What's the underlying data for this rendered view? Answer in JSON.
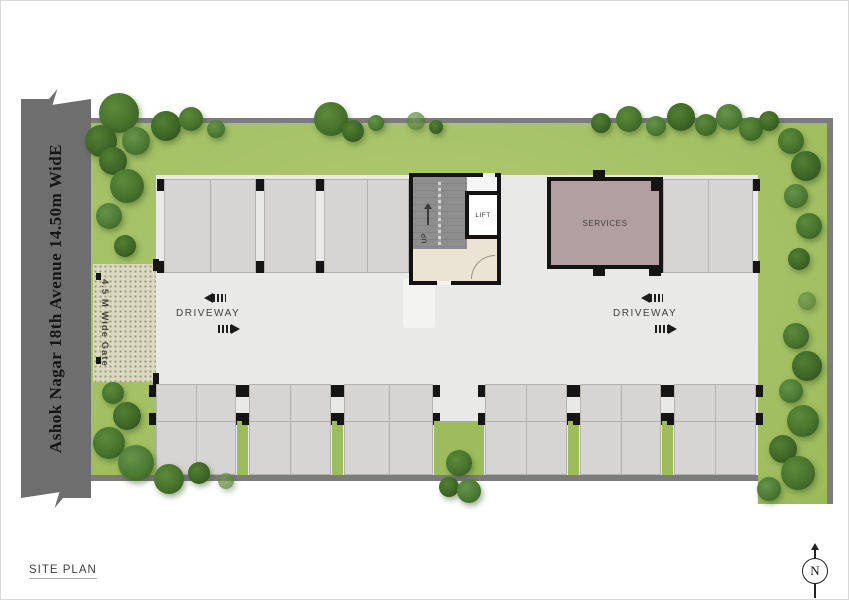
{
  "page": {
    "title": "SITE PLAN"
  },
  "road": {
    "label": "Ashok Nagar 18th Avenue 14.50m WidE"
  },
  "gate": {
    "label": "4.5 M Wide Gate"
  },
  "driveways": {
    "left": "DRIVEWAY",
    "right": "DRIVEWAY"
  },
  "core": {
    "up": "UP",
    "lift": "LIFT"
  },
  "services": {
    "label": "SERVICES"
  },
  "compass": {
    "north": "N"
  },
  "colors": {
    "road": "#6e6e6e",
    "lawn": "#a6c267",
    "wall": "#7c7c7c",
    "paving": "#e9e9e7",
    "stall": "#d7d5d3",
    "column": "#151515",
    "services": "#b2a0a0",
    "stair": "#8b8b8b",
    "lobby": "#ebe4d4",
    "gate": "#dbd9c0",
    "tree": "#3e6626"
  },
  "trees": [
    [
      118,
      112,
      20,
      0
    ],
    [
      100,
      140,
      16,
      1
    ],
    [
      135,
      140,
      14,
      2
    ],
    [
      165,
      125,
      15,
      1
    ],
    [
      190,
      118,
      12,
      0
    ],
    [
      215,
      128,
      9,
      2
    ],
    [
      330,
      118,
      17,
      0
    ],
    [
      352,
      130,
      11,
      1
    ],
    [
      375,
      122,
      8,
      2
    ],
    [
      415,
      120,
      9,
      3
    ],
    [
      435,
      126,
      7,
      1
    ],
    [
      600,
      122,
      10,
      1
    ],
    [
      628,
      118,
      13,
      0
    ],
    [
      655,
      125,
      10,
      2
    ],
    [
      680,
      116,
      14,
      1
    ],
    [
      705,
      124,
      11,
      0
    ],
    [
      728,
      116,
      13,
      2
    ],
    [
      750,
      128,
      12,
      0
    ],
    [
      768,
      120,
      10,
      1
    ],
    [
      790,
      140,
      13,
      0
    ],
    [
      805,
      165,
      15,
      1
    ],
    [
      795,
      195,
      12,
      2
    ],
    [
      808,
      225,
      13,
      0
    ],
    [
      798,
      258,
      11,
      1
    ],
    [
      806,
      300,
      9,
      3
    ],
    [
      795,
      335,
      13,
      0
    ],
    [
      806,
      365,
      15,
      1
    ],
    [
      790,
      390,
      12,
      2
    ],
    [
      802,
      420,
      16,
      0
    ],
    [
      782,
      448,
      14,
      1
    ],
    [
      797,
      472,
      17,
      0
    ],
    [
      768,
      488,
      12,
      2
    ],
    [
      112,
      160,
      14,
      1
    ],
    [
      126,
      185,
      17,
      0
    ],
    [
      108,
      215,
      13,
      2
    ],
    [
      124,
      245,
      11,
      1
    ],
    [
      112,
      392,
      11,
      0
    ],
    [
      126,
      415,
      14,
      1
    ],
    [
      108,
      442,
      16,
      0
    ],
    [
      135,
      462,
      18,
      2
    ],
    [
      168,
      478,
      15,
      0
    ],
    [
      198,
      472,
      11,
      1
    ],
    [
      225,
      480,
      8,
      3
    ],
    [
      458,
      462,
      13,
      0
    ],
    [
      448,
      486,
      10,
      1
    ],
    [
      468,
      490,
      12,
      2
    ]
  ],
  "parking": {
    "top_groups": [
      {
        "x": 163,
        "w": 92,
        "stalls": 2
      },
      {
        "x": 263,
        "w": 52,
        "stalls": 1
      },
      {
        "x": 323,
        "w": 85,
        "stalls": 2
      },
      {
        "x": 662,
        "w": 90,
        "stalls": 2
      }
    ],
    "top_y": 178,
    "top_h": 94,
    "bottom_groups": [
      {
        "x": 155,
        "w": 80,
        "stalls": 2
      },
      {
        "x": 248,
        "w": 82,
        "stalls": 2
      },
      {
        "x": 343,
        "w": 89,
        "stalls": 2
      },
      {
        "x": 484,
        "w": 82,
        "stalls": 2
      },
      {
        "x": 579,
        "w": 81,
        "stalls": 2
      },
      {
        "x": 673,
        "w": 82,
        "stalls": 2
      }
    ],
    "bottom_y": 383,
    "bottom_h_upper": 37,
    "bottom_h_lower": 54
  }
}
